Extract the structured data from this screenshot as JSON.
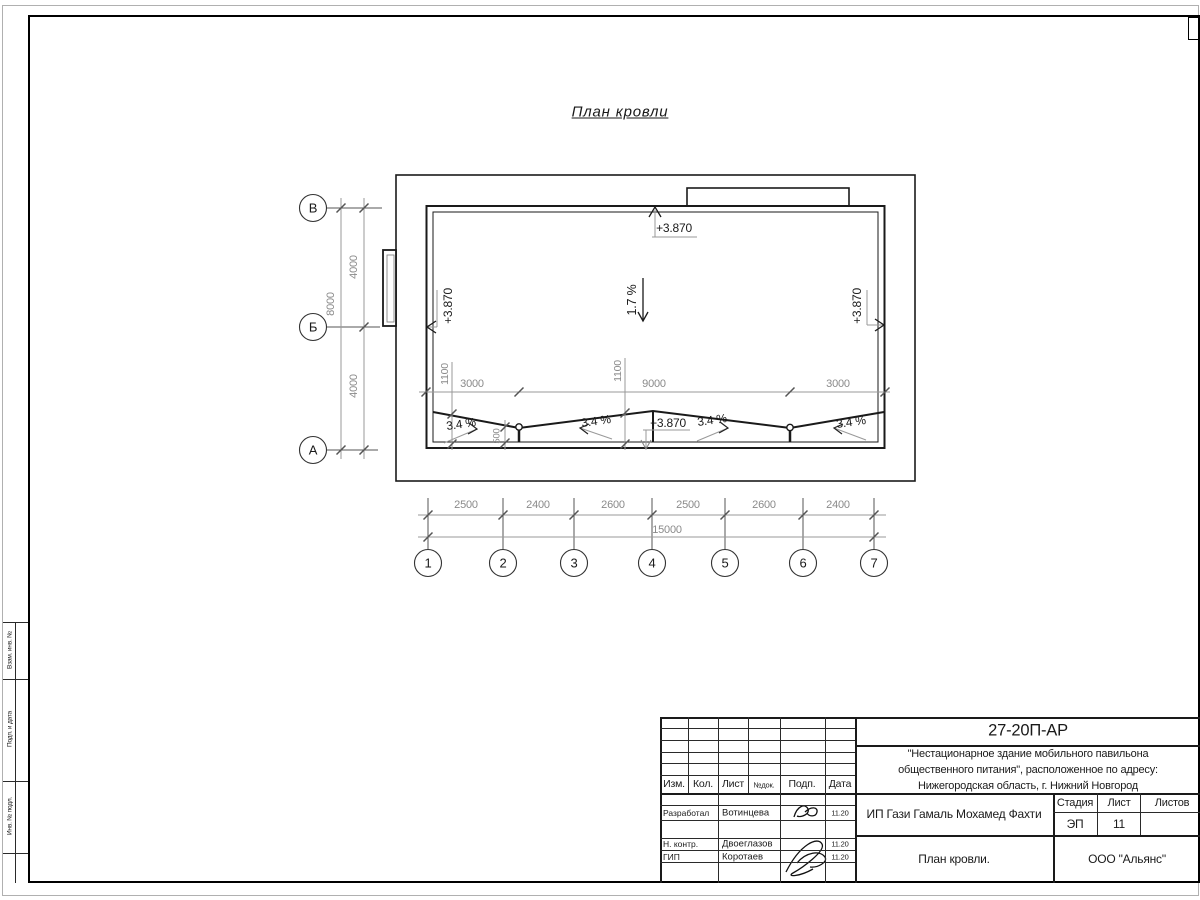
{
  "title": "План кровли",
  "axes": {
    "left": [
      "В",
      "Б",
      "А"
    ],
    "bottom": [
      "1",
      "2",
      "3",
      "4",
      "5",
      "6",
      "7"
    ]
  },
  "dims": {
    "left_segments": [
      "4000",
      "4000"
    ],
    "left_total": "8000",
    "bottom_segments": [
      "2500",
      "2400",
      "2600",
      "2500",
      "2600",
      "2400"
    ],
    "bottom_total": "15000",
    "inner_segments": [
      "3000",
      "9000",
      "3000"
    ],
    "inner_offsets": [
      "1100",
      "1100"
    ],
    "drain_offset": "500"
  },
  "marks": {
    "elev_top": "+3.870",
    "elev_left": "+3.870",
    "elev_right": "+3.870",
    "elev_peak": "+3.870",
    "slope_main": "1.7 %",
    "slopes": [
      "3.4 %",
      "3.4 %",
      "3.4 %",
      "3.4 %"
    ]
  },
  "side_strip": [
    "Взам. инв. №",
    "Подп. и дата",
    "Инв. № подл."
  ],
  "titleblock": {
    "code": "27-20П-АР",
    "project_line1": "\"Нестационарное здание мобильного павильона",
    "project_line2": "общественного питания\", расположенное по адресу:",
    "project_line3": "Нижегородская область, г. Нижний Новгород",
    "client": "ИП Гази Гамаль Мохамед Фахти",
    "sheet_title": "План кровли.",
    "company": "ООО \"Альянс\"",
    "cols": {
      "izm": "Изм.",
      "kol": "Кол.",
      "list": "Лист",
      "ndoc": "№док.",
      "podp": "Подп.",
      "data": "Дата"
    },
    "stadia_label": "Стадия",
    "list_label": "Лист",
    "listov_label": "Листов",
    "stadia_value": "ЭП",
    "list_value": "11",
    "rows": [
      {
        "role": "Разработал",
        "name": "Вотинцева",
        "date": "11.20"
      },
      {
        "role": "Н. контр.",
        "name": "Двоеглазов",
        "date": "11.20"
      },
      {
        "role": "ГИП",
        "name": "Коротаев",
        "date": "11.20"
      }
    ]
  }
}
